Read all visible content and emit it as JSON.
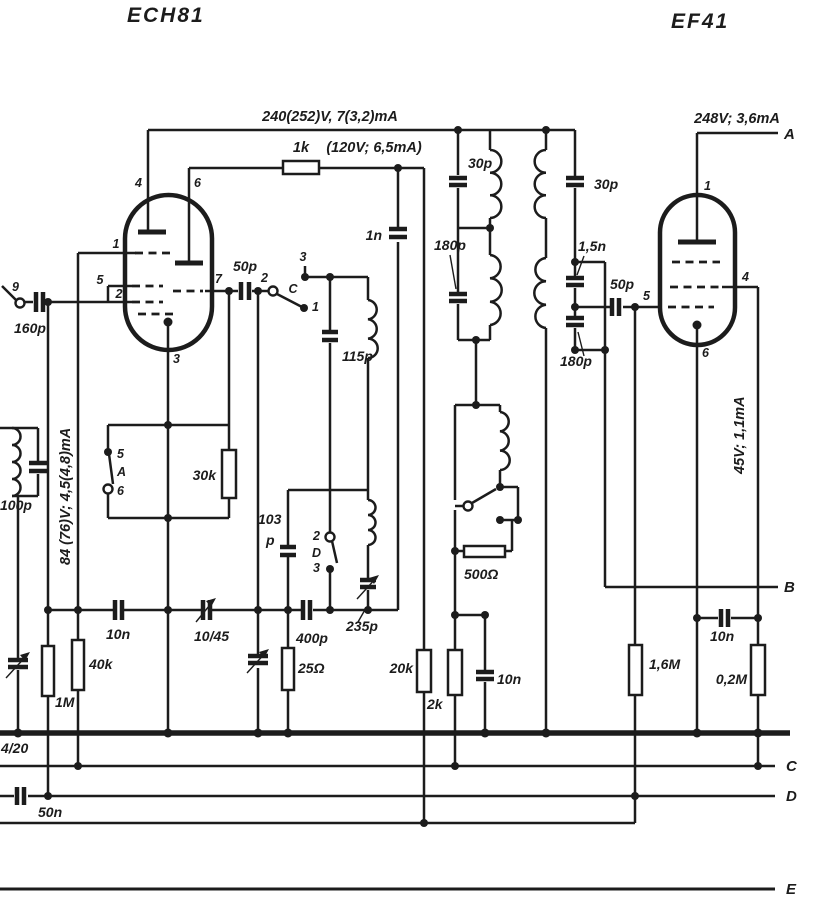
{
  "colors": {
    "ink": "#1c1c1c",
    "background": "#ffffff"
  },
  "tubes": {
    "t1": "ECH81",
    "t2": "EF41"
  },
  "notes": {
    "supply_main": "240(252)V, 7(3,2)mA",
    "screen": "(120V; 6,5mA)",
    "supply_ef41": "248V; 3,6mA",
    "anode_ech": "84 (76)V; 4,5(4,8)mA",
    "screen_ef41": "45V; 1,1mA"
  },
  "terminals": {
    "a": "A",
    "b": "B",
    "c": "C",
    "d": "D",
    "e": "E"
  },
  "resistors": {
    "r1k": "1k",
    "r30k": "30k",
    "r500": "500Ω",
    "r25": "25Ω",
    "r20k": "20k",
    "r2k": "2k",
    "r40k": "40k",
    "r1m": "1M",
    "r16m": "1,6M",
    "r02m": "0,2M"
  },
  "caps": {
    "c160p": "160p",
    "c100p": "100p",
    "c50p_1": "50p",
    "c50p_2": "50p",
    "c1n": "1n",
    "c115p": "115p",
    "c103p_line1": "103",
    "c103p_line2": "p",
    "c30p_1": "30p",
    "c30p_2": "30p",
    "c180p_1": "180p",
    "c180p_2": "180p",
    "c15n": "1,5n",
    "c10n_1": "10n",
    "c10n_2": "10n",
    "c10n_3": "10n",
    "c400p": "400p",
    "c50n": "50n"
  },
  "trimmers": {
    "t1045": "10/45",
    "t235p": "235p",
    "t420": "4/20"
  },
  "pins_ech81": {
    "p1": "1",
    "p2": "2",
    "p3": "3",
    "p4": "4",
    "p5": "5",
    "p6": "6",
    "p7": "7",
    "p9": "9"
  },
  "pins_ef41": {
    "p1": "1",
    "p4": "4",
    "p5": "5",
    "p6": "6"
  },
  "switches": {
    "sa": {
      "name": "A",
      "c5": "5",
      "c6": "6"
    },
    "sc": {
      "name": "C",
      "c1": "1",
      "c2": "2",
      "c3": "3"
    },
    "sd": {
      "name": "D",
      "c2": "2",
      "c3": "3"
    }
  }
}
